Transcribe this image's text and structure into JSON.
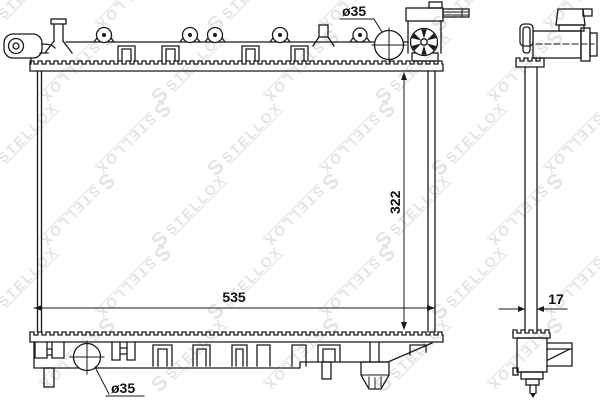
{
  "page": {
    "background": "#ffffff",
    "line_color": "#1a1a1a"
  },
  "watermark": {
    "logo": "S",
    "text": "STELLOX",
    "color": "#e4e4e4"
  },
  "dimensions": {
    "top_pipe_diameter": "ø35",
    "bottom_pipe_diameter": "ø35",
    "core_width": "535",
    "core_height": "322",
    "side_depth": "17"
  }
}
